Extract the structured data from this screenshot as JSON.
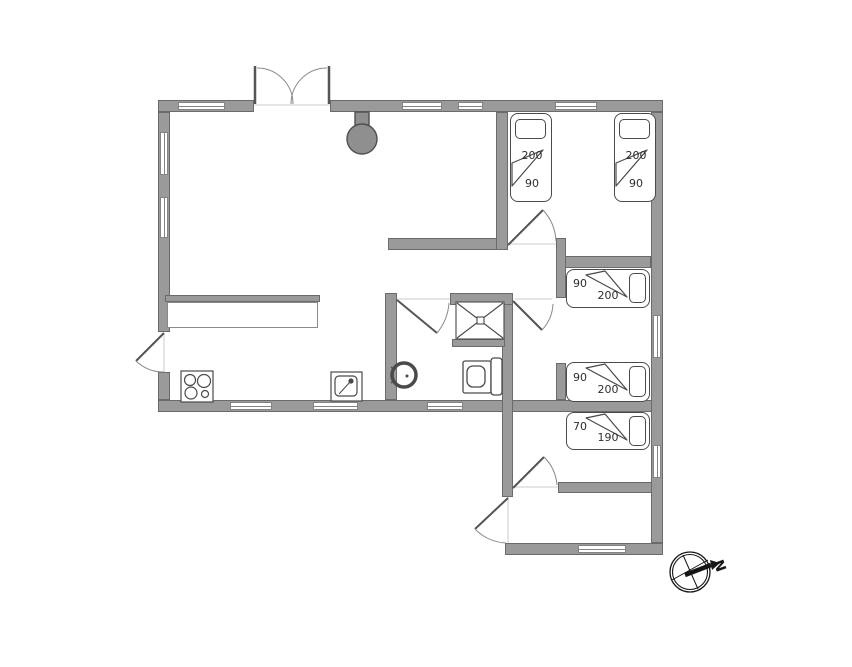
{
  "plan_title": "summerhouse-floor-plan",
  "beds": {
    "top_right_1": {
      "length": "200",
      "width": "90"
    },
    "top_right_2": {
      "length": "200",
      "width": "90"
    },
    "mid_upper": {
      "width": "90",
      "length": "200"
    },
    "mid_lower": {
      "width": "90",
      "length": "200"
    },
    "bottom": {
      "width": "70",
      "length": "190"
    }
  },
  "compass": {
    "north_label": "N"
  },
  "colors": {
    "wall_fill": "#9a9a9a",
    "wall_border": "#6b6b6b",
    "fixture_line": "#4a4a4a",
    "stove_fill": "#8f8f8f",
    "background": "#ffffff",
    "label_text": "#2e2e2e"
  },
  "fixture_icons": [
    "wood-stove-icon",
    "cooktop-icon",
    "kitchen-sink-icon",
    "washbasin-icon",
    "toilet-icon",
    "shower-icon",
    "compass-icon"
  ]
}
